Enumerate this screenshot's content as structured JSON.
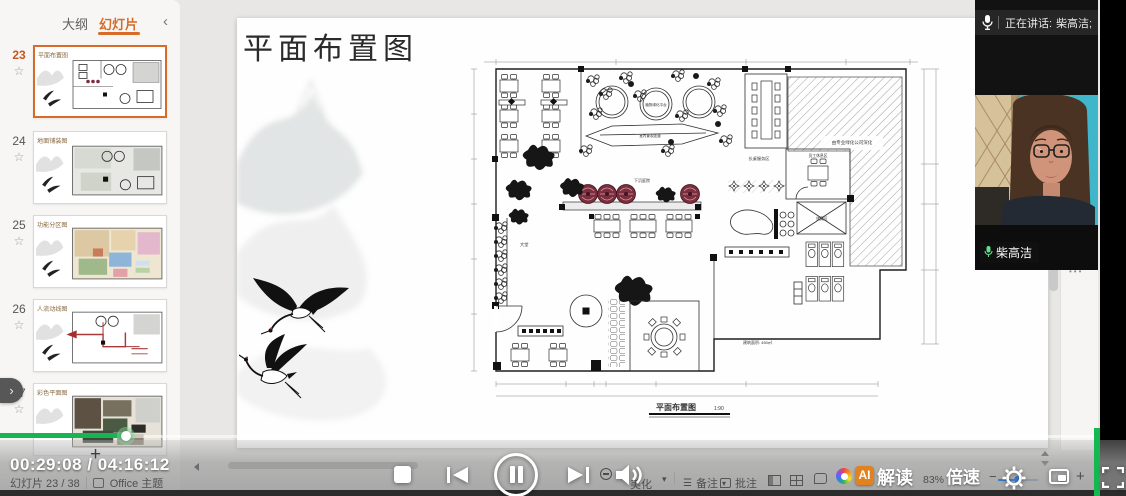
{
  "sidebar": {
    "tabs": [
      {
        "label": "大纲"
      },
      {
        "label": "幻灯片"
      }
    ],
    "collapse_icon": "‹",
    "slides": [
      {
        "num": "23",
        "title": "平面布置图"
      },
      {
        "num": "24",
        "title": "地面铺装图"
      },
      {
        "num": "25",
        "title": "功能分区图"
      },
      {
        "num": "26",
        "title": "人流动线图"
      },
      {
        "num": "27",
        "title": "彩色平面图"
      }
    ],
    "star_icon": "☆",
    "add_slide_label": "+",
    "next_pill_icon": "›",
    "more_dots": "•••"
  },
  "slide": {
    "title": "平面布置图",
    "plan": {
      "caption": "平面布置图",
      "scale": "1:90",
      "area_note": "建筑面积: 450㎡",
      "labels": {
        "lobby": "大堂",
        "sunken_corridor": "下沉庭院",
        "green_platform": "植物绿化平台",
        "walkway": "室内景观走道",
        "long_table": "长桌服务区",
        "staff_room": "员工休息区",
        "storage": "储藏区",
        "neighbor": "由专业绿化公司深化"
      }
    }
  },
  "meeting": {
    "speaking_prefix": "正在讲话:",
    "speaking_name": "柴高洁;",
    "name_tag": "柴高洁"
  },
  "player": {
    "current_time": "00:29:08",
    "time_separator": "/",
    "total_time": "04:16:12",
    "ai_logo_text": "AI",
    "ai_badge_rest": "解读",
    "speed_label": "倍速"
  },
  "status_bar": {
    "slide_counter": "幻灯片 23 / 38",
    "theme_label": "Office 主题",
    "beautify": "美化",
    "notes": "备注",
    "comments": "批注",
    "zoom_level": "83%",
    "caret": "▾",
    "minus": "−",
    "plus": "+"
  }
}
